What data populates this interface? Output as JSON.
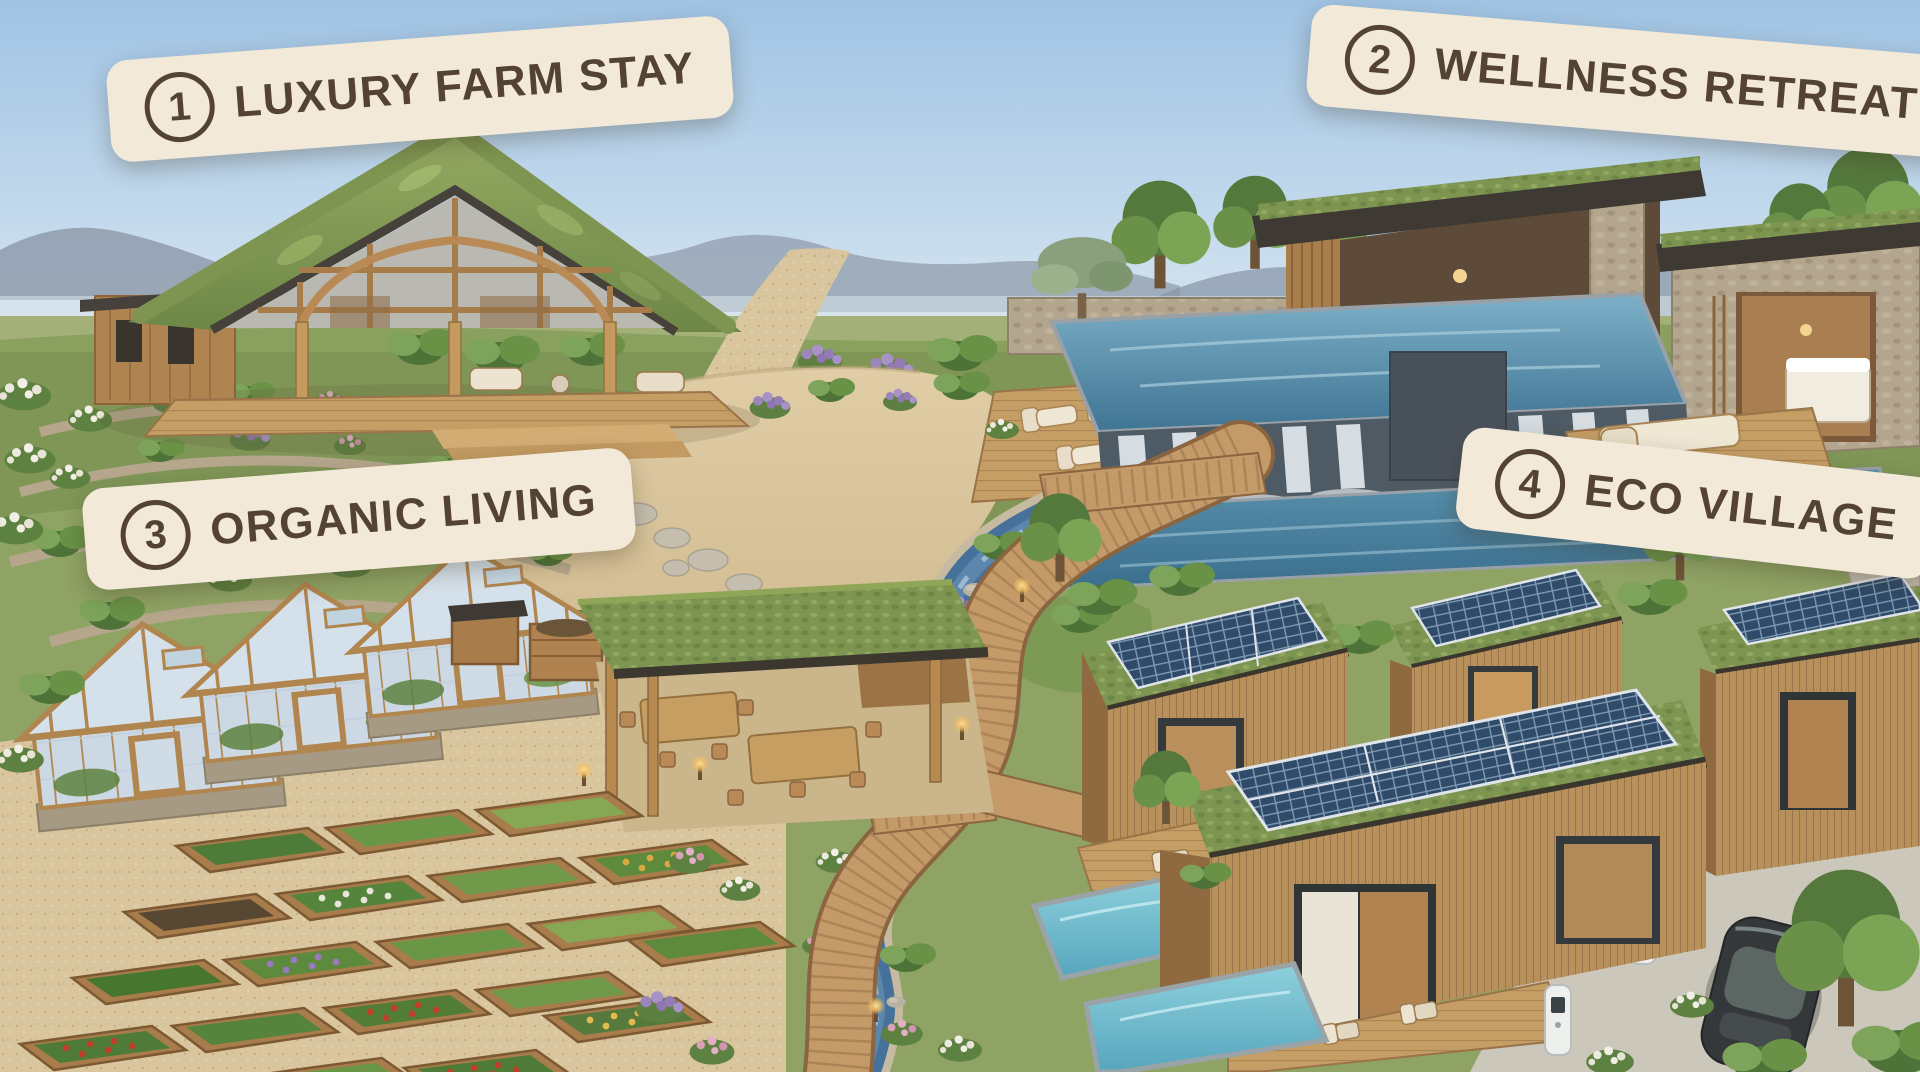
{
  "scene": {
    "description": "Aerial illustration of a sustainable eco-resort masterplan with four labeled zones",
    "labels": [
      {
        "number": "1",
        "title": "LUXURY FARM STAY"
      },
      {
        "number": "2",
        "title": "WELLNESS RETREAT"
      },
      {
        "number": "3",
        "title": "ORGANIC LIVING"
      },
      {
        "number": "4",
        "title": "ECO VILLAGE"
      }
    ],
    "colors": {
      "sky_top": "#a3c6e4",
      "sky_horizon": "#dbe8f1",
      "label_background": "#f2e9d8",
      "label_text": "#544335",
      "pool_water": "#4e86a3",
      "plunge_pool_water": "#6fbcd0",
      "stream_water": "#4a6f96",
      "wood": "#bb8f5d",
      "green_roof": "#7a9150",
      "gravel_path": "#d8c8a4",
      "solar_panel": "#2f4b69",
      "vegetation": "#5d8140"
    }
  }
}
